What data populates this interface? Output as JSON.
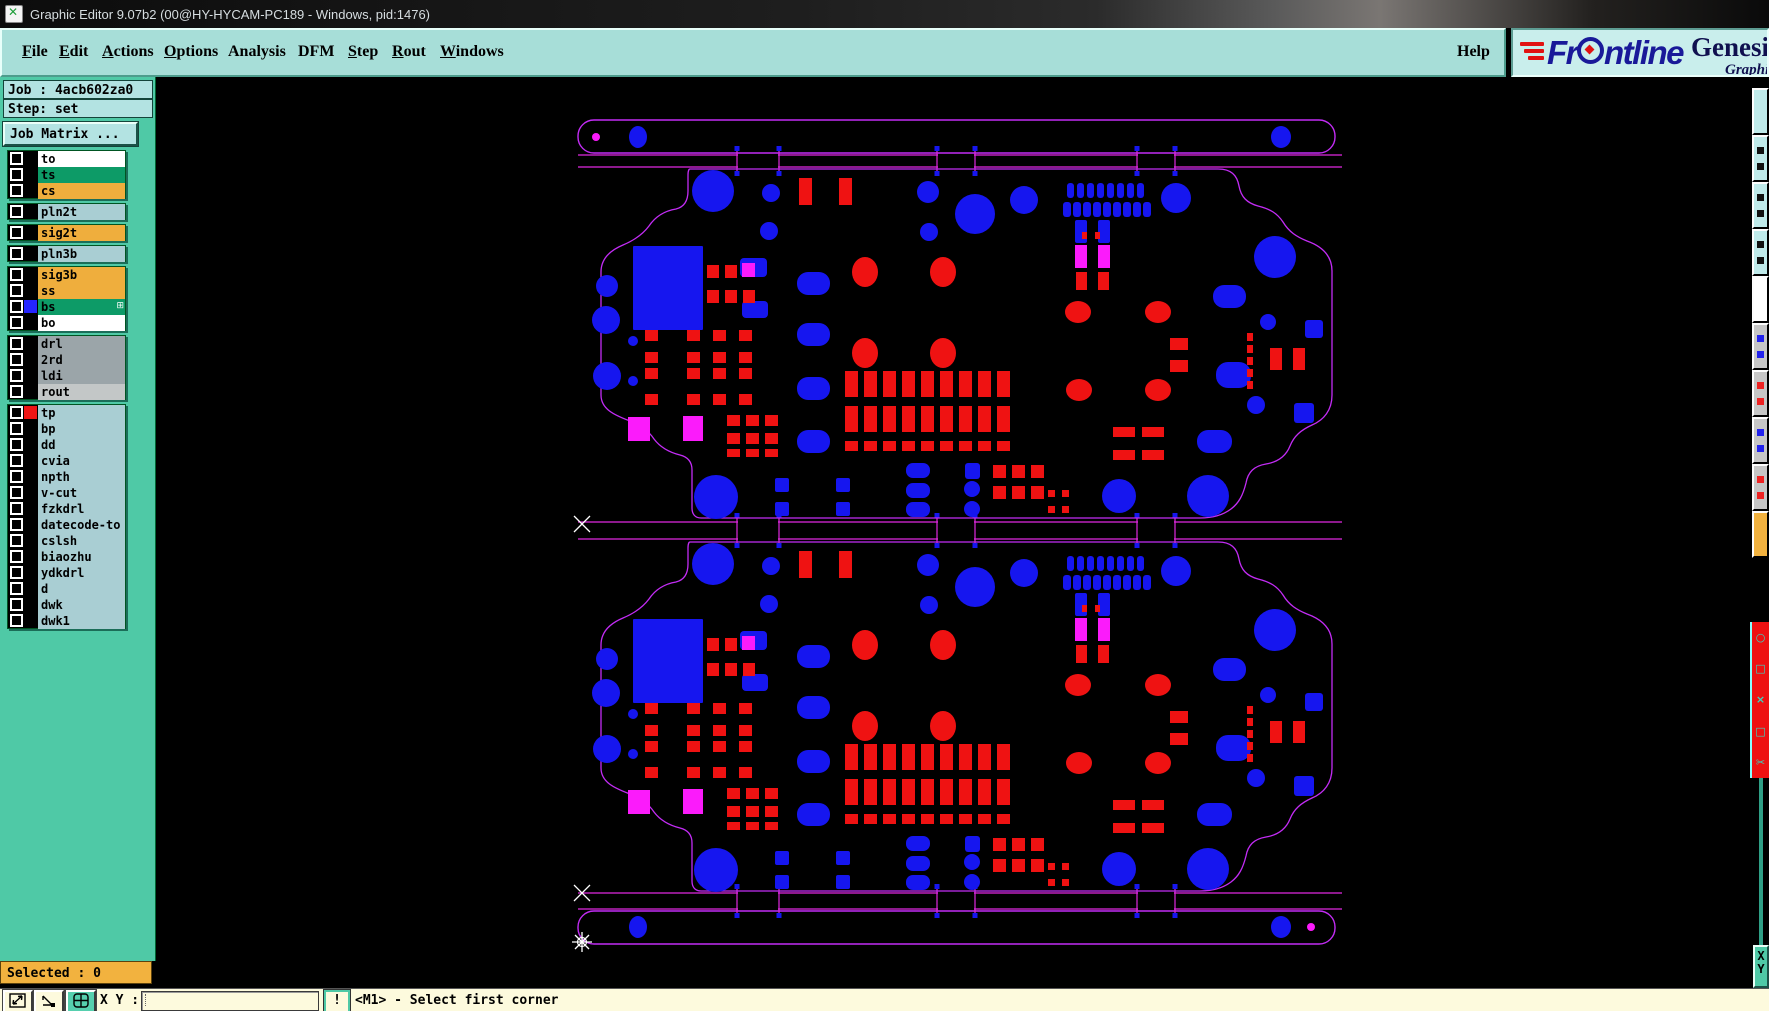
{
  "title_bar": {
    "title": "Graphic Editor 9.07b2 (00@HY-HYCAM-PC189 - Windows, pid:1476)"
  },
  "menu": {
    "items": [
      {
        "label": "File",
        "u": 0
      },
      {
        "label": "Edit",
        "u": 0
      },
      {
        "label": "Actions",
        "u": 0
      },
      {
        "label": "Options",
        "u": 0
      },
      {
        "label": "Analysis",
        "u": -1
      },
      {
        "label": "DFM",
        "u": -1
      },
      {
        "label": "Step",
        "u": 0
      },
      {
        "label": "Rout",
        "u": 0
      },
      {
        "label": "Windows",
        "u": 0
      }
    ],
    "help": {
      "label": "Help",
      "u": -1
    }
  },
  "logo": {
    "brand_pre": "Fr",
    "brand_post": "ntline",
    "product": "Genesis 2",
    "subtitle": "Graphic Ed"
  },
  "job_panel": {
    "job": "Job : 4acb602za0",
    "step": "Step: set",
    "matrix_button": "Job Matrix ..."
  },
  "layer_list": {
    "groups": [
      {
        "rows": [
          {
            "name": "to",
            "bg": "#ffffff"
          },
          {
            "name": "ts",
            "bg": "#0d9b67"
          },
          {
            "name": "cs",
            "bg": "#efae3d"
          }
        ]
      },
      {
        "rows": [
          {
            "name": "pln2t",
            "bg": "#a9ced3"
          }
        ]
      },
      {
        "rows": [
          {
            "name": "sig2t",
            "bg": "#efae3d"
          }
        ]
      },
      {
        "rows": [
          {
            "name": "pln3b",
            "bg": "#a9ced3"
          }
        ]
      },
      {
        "rows": [
          {
            "name": "sig3b",
            "bg": "#efae3d"
          },
          {
            "name": "ss",
            "bg": "#efae3d"
          },
          {
            "name": "bs",
            "bg": "#0d9b67",
            "swatch": "#2525ff",
            "badge": "⊞"
          },
          {
            "name": "bo",
            "bg": "#ffffff"
          }
        ]
      },
      {
        "rows": [
          {
            "name": "drl",
            "bg": "#9ba5a9"
          },
          {
            "name": "2rd",
            "bg": "#9ba5a9"
          },
          {
            "name": "ldi",
            "bg": "#9ba5a9"
          },
          {
            "name": "rout",
            "bg": "#c3c7c7"
          }
        ]
      },
      {
        "rows": [
          {
            "name": "tp",
            "bg": "#a9ced3",
            "swatch": "#ee1515"
          },
          {
            "name": "bp",
            "bg": "#a9ced3"
          },
          {
            "name": "dd",
            "bg": "#a9ced3"
          },
          {
            "name": "cvia",
            "bg": "#a9ced3"
          },
          {
            "name": "npth",
            "bg": "#a9ced3"
          },
          {
            "name": "v-cut",
            "bg": "#a9ced3"
          },
          {
            "name": "fzkdrl",
            "bg": "#a9ced3"
          },
          {
            "name": "datecode-to",
            "bg": "#a9ced3"
          },
          {
            "name": "cslsh",
            "bg": "#a9ced3"
          },
          {
            "name": "biaozhu",
            "bg": "#a9ced3"
          },
          {
            "name": "ydkdrl",
            "bg": "#a9ced3"
          },
          {
            "name": "d",
            "bg": "#a9ced3"
          },
          {
            "name": "dwk",
            "bg": "#a9ced3"
          },
          {
            "name": "dwk1",
            "bg": "#a9ced3"
          }
        ]
      }
    ]
  },
  "selected_bar": {
    "text": "Selected : 0"
  },
  "status_bar": {
    "xy_label": "X Y :",
    "input_value": "",
    "alert": "!",
    "message": "<M1> - Select first corner"
  },
  "right_panel": {
    "x_label": "X",
    "y_label": "Y"
  },
  "right_strip": {
    "buttons": [
      {
        "bg": "#bfeaea"
      },
      {
        "bg": "#bfeaea",
        "dot": "#111111"
      },
      {
        "bg": "#bfeaea",
        "dot": "#111111"
      },
      {
        "bg": "#bfeaea",
        "dot": "#111111"
      },
      {
        "bg": "#ffffff"
      },
      {
        "bg": "#c6c6c6",
        "dot": "#2222ee"
      },
      {
        "bg": "#c6c6c6",
        "dot": "#ee2222"
      },
      {
        "bg": "#c6c6c6",
        "dot": "#2222ee"
      },
      {
        "bg": "#c6c6c6",
        "dot": "#ee2222"
      },
      {
        "bg": "#f2b23f"
      }
    ],
    "red_panel_glyphs": [
      "○",
      "□",
      "×",
      "□",
      "✂"
    ]
  },
  "canvas": {
    "colors": {
      "outline": "#c32cf5",
      "line": "#e128e1",
      "blue": "#1616ef",
      "red": "#ef1212",
      "magenta": "#fb1bfb",
      "marker": "#ffffff"
    },
    "rails": [
      {
        "x": 578,
        "y": 120,
        "w": 757,
        "h": 33,
        "blue": [
          [
            638,
            137,
            9,
            11
          ],
          [
            1281,
            137,
            10,
            11
          ]
        ],
        "magenta": [
          [
            596,
            137,
            4
          ]
        ]
      },
      {
        "x": 578,
        "y": 911,
        "w": 757,
        "h": 33,
        "blue": [
          [
            638,
            927,
            9,
            11
          ],
          [
            1281,
            927,
            10,
            11
          ]
        ],
        "magenta": [
          [
            1311,
            927,
            4
          ]
        ]
      }
    ],
    "separators": [
      {
        "y1": 155,
        "y2": 167
      },
      {
        "y1": 522,
        "y2": 539
      },
      {
        "y1": 893,
        "y2": 909
      }
    ],
    "sep_x": [
      578,
      1342
    ],
    "tabs": [
      [
        737,
        779
      ],
      [
        937,
        975
      ],
      [
        1137,
        1175
      ]
    ],
    "markers": {
      "crosses": [
        [
          582,
          524
        ],
        [
          582,
          893
        ]
      ],
      "star": [
        582,
        942
      ]
    },
    "board_offsets": [
      0,
      373
    ],
    "board_outline": "M 690,169 L 1218,169 C 1231,169 1237,175 1239,186 C 1241,197 1247,203 1258,206 C 1270,209 1277,213 1283,222 C 1289,232 1297,237 1307,241 C 1321,246 1332,255 1332,271 L 1332,395 C 1332,410 1324,420 1312,425 C 1301,430 1294,436 1290,446 C 1286,456 1278,462 1266,464 C 1254,466 1248,472 1246,483 C 1243,495 1239,503 1231,509 C 1223,515 1212,518 1200,518 L 701,518 C 695,518 692,514 692,508 L 692,470 C 692,462 688,457 680,455 C 668,452 660,447 654,439 C 648,430 640,425 630,421 C 614,415 601,409 601,395 L 601,272 C 601,258 611,250 623,245 C 635,240 643,234 649,226 C 655,217 664,211 676,209 C 684,207 688,201 688,191 L 688,175 C 688,171 689,169 690,169 Z",
    "blue_circles": [
      [
        713,
        191,
        21
      ],
      [
        771,
        193,
        9
      ],
      [
        769,
        231,
        9
      ],
      [
        928,
        192,
        11
      ],
      [
        975,
        214,
        20
      ],
      [
        929,
        232,
        9
      ],
      [
        607,
        286,
        11
      ],
      [
        606,
        320,
        14
      ],
      [
        607,
        376,
        14
      ],
      [
        633,
        341,
        5
      ],
      [
        633,
        381,
        5
      ],
      [
        1024,
        200,
        14
      ],
      [
        1176,
        198,
        15
      ],
      [
        1275,
        257,
        21
      ],
      [
        716,
        497,
        22
      ],
      [
        1119,
        496,
        17
      ],
      [
        1208,
        496,
        21
      ],
      [
        1268,
        322,
        8
      ],
      [
        1256,
        405,
        9
      ],
      [
        972,
        489,
        8
      ],
      [
        972,
        509,
        8
      ]
    ],
    "blue_grids": [
      {
        "xs": [
          1067,
          1077,
          1087,
          1097,
          1107,
          1117,
          1127,
          1137
        ],
        "ys": [
          183
        ],
        "w": 7,
        "h": 15,
        "r": 3
      },
      {
        "xs": [
          1063,
          1073,
          1083,
          1093,
          1103,
          1113,
          1123,
          1133,
          1143
        ],
        "ys": [
          202
        ],
        "w": 8,
        "h": 15,
        "r": 3
      },
      {
        "xs": [
          775,
          836
        ],
        "ys": [
          478,
          502
        ],
        "w": 14,
        "h": 14,
        "r": 2
      },
      {
        "xs": [
          797
        ],
        "ys": [
          272,
          323,
          377,
          430
        ],
        "w": 33,
        "h": 23,
        "r": 11
      },
      {
        "xs": [
          906
        ],
        "ys": [
          463,
          483,
          502
        ],
        "w": 24,
        "h": 15,
        "r": 7
      },
      {
        "xs": [
          1075,
          1098
        ],
        "ys": [
          220
        ],
        "w": 12,
        "h": 23,
        "r": 2
      },
      {
        "xs": [
          633
        ],
        "ys": [
          246
        ],
        "w": 70,
        "h": 84,
        "r": 1
      },
      {
        "xs": [
          740
        ],
        "ys": [
          258
        ],
        "w": 27,
        "h": 19,
        "r": 4
      },
      {
        "xs": [
          742
        ],
        "ys": [
          301
        ],
        "w": 26,
        "h": 17,
        "r": 4
      },
      {
        "xs": [
          1213
        ],
        "ys": [
          285
        ],
        "w": 33,
        "h": 23,
        "r": 11
      },
      {
        "xs": [
          1216
        ],
        "ys": [
          362
        ],
        "w": 35,
        "h": 26,
        "r": 12
      },
      {
        "xs": [
          1197
        ],
        "ys": [
          430
        ],
        "w": 35,
        "h": 23,
        "r": 11
      },
      {
        "xs": [
          1305
        ],
        "ys": [
          320
        ],
        "w": 18,
        "h": 18,
        "r": 3
      },
      {
        "xs": [
          1294
        ],
        "ys": [
          403
        ],
        "w": 20,
        "h": 20,
        "r": 3
      },
      {
        "xs": [
          965
        ],
        "ys": [
          463
        ],
        "w": 15,
        "h": 16,
        "r": 3
      }
    ],
    "red_grids": [
      {
        "xs": [
          799,
          839
        ],
        "ys": [
          178
        ],
        "w": 13,
        "h": 27
      },
      {
        "xs": [
          707,
          725
        ],
        "ys": [
          265
        ],
        "w": 12,
        "h": 13
      },
      {
        "xs": [
          707,
          725,
          743
        ],
        "ys": [
          290
        ],
        "w": 12,
        "h": 13
      },
      {
        "xs": [
          645,
          687,
          713,
          739
        ],
        "ys": [
          330,
          352,
          368,
          394
        ],
        "w": 13,
        "h": 11
      },
      {
        "xs": [
          727,
          746,
          765
        ],
        "ys": [
          415,
          433
        ],
        "w": 13,
        "h": 11
      },
      {
        "xs": [
          727,
          746,
          765
        ],
        "ys": [
          449
        ],
        "w": 13,
        "h": 8
      },
      {
        "xs": [
          845,
          864,
          883,
          902,
          921,
          940,
          959,
          978,
          997
        ],
        "ys": [
          371,
          406
        ],
        "w": 13,
        "h": 26
      },
      {
        "xs": [
          845,
          864,
          883,
          902,
          921,
          940,
          959,
          978,
          997
        ],
        "ys": [
          441
        ],
        "w": 13,
        "h": 10
      },
      {
        "xs": [
          993,
          1012,
          1031
        ],
        "ys": [
          465,
          486
        ],
        "w": 13,
        "h": 13
      },
      {
        "xs": [
          1048,
          1062
        ],
        "ys": [
          490,
          506
        ],
        "w": 7,
        "h": 7
      },
      {
        "xs": [
          1113,
          1142
        ],
        "ys": [
          427,
          450
        ],
        "w": 22,
        "h": 10
      },
      {
        "xs": [
          1170
        ],
        "ys": [
          338,
          360
        ],
        "w": 18,
        "h": 12
      },
      {
        "xs": [
          1247
        ],
        "ys": [
          333,
          345,
          357,
          369,
          381
        ],
        "w": 6,
        "h": 8
      },
      {
        "xs": [
          1270,
          1293
        ],
        "ys": [
          348
        ],
        "w": 12,
        "h": 22
      },
      {
        "xs": [
          1076,
          1098
        ],
        "ys": [
          272
        ],
        "w": 11,
        "h": 18
      },
      {
        "xs": [
          1082,
          1095
        ],
        "ys": [
          232
        ],
        "w": 5,
        "h": 7
      }
    ],
    "red_ellipses": [
      [
        865,
        272,
        13,
        15
      ],
      [
        865,
        353,
        13,
        15
      ],
      [
        943,
        272,
        13,
        15
      ],
      [
        943,
        353,
        13,
        15
      ],
      [
        1078,
        312,
        13,
        11
      ],
      [
        1158,
        312,
        13,
        11
      ],
      [
        1079,
        390,
        13,
        11
      ],
      [
        1158,
        390,
        13,
        11
      ]
    ],
    "magenta_rects": [
      [
        628,
        417,
        22,
        24
      ],
      [
        683,
        416,
        20,
        25
      ],
      [
        742,
        263,
        13,
        14
      ],
      [
        1075,
        245,
        12,
        23
      ],
      [
        1098,
        245,
        12,
        23
      ]
    ]
  }
}
